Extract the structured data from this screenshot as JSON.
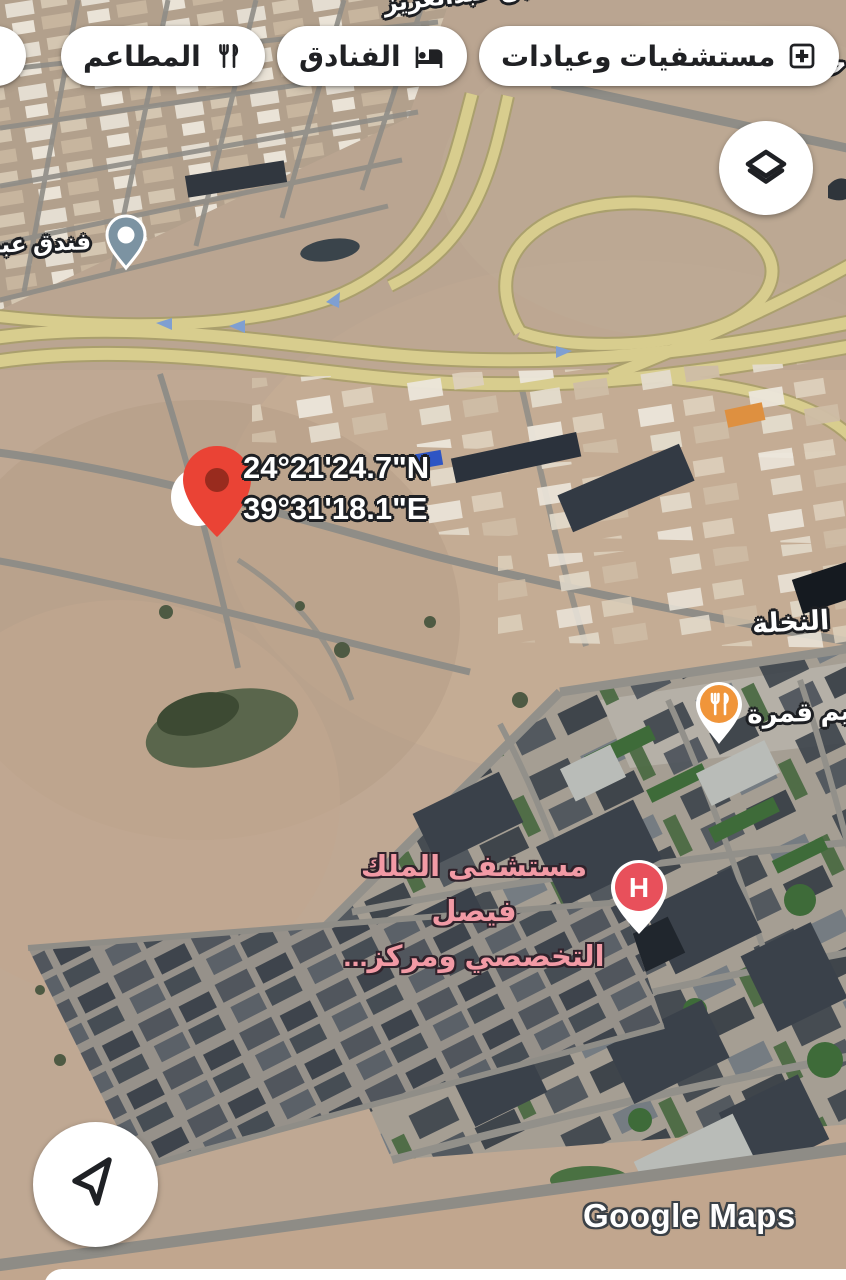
{
  "map": {
    "road_label": "طريق الأمير نايف بن عبدالعزيز",
    "edge_fragment": "حه",
    "district_label": "النخلة",
    "watermark": "Google Maps"
  },
  "top_bar": {
    "chips": [
      {
        "id": "cafes",
        "label": "",
        "icon": "coffee-cup-icon"
      },
      {
        "id": "restaurants",
        "label": "المطاعم",
        "icon": "restaurant-icon"
      },
      {
        "id": "hotels",
        "label": "الفنادق",
        "icon": "bed-icon"
      },
      {
        "id": "hospitals",
        "label": "مستشفيات وعيادات",
        "icon": "hospital-cross-icon"
      }
    ]
  },
  "markers": {
    "dropped_pin": {
      "coords_line1": "24°21'24.7\"N",
      "coords_line2": "39°31'18.1\"E",
      "color": "#EA4335"
    },
    "hotel": {
      "label": "فندق عبد",
      "color": "#7C93A2"
    },
    "restaurant": {
      "label": "ميم قمرة",
      "color": "#F0953A"
    },
    "hospital": {
      "letter": "H",
      "label_line1": "مستشفى الملك فيصل",
      "label_line2": "التخصصي ومركز...",
      "color": "#E8505B"
    }
  },
  "controls": {
    "layers_button_icon": "layers-icon",
    "compass_button_icon": "navigation-arrow-icon"
  },
  "colors": {
    "sand": "#BCA590",
    "road_yellow": "#D8CD8E",
    "label_outline": "#1D1F23",
    "hospital_label_text": "#F29AA5",
    "chip_text": "#202124"
  }
}
